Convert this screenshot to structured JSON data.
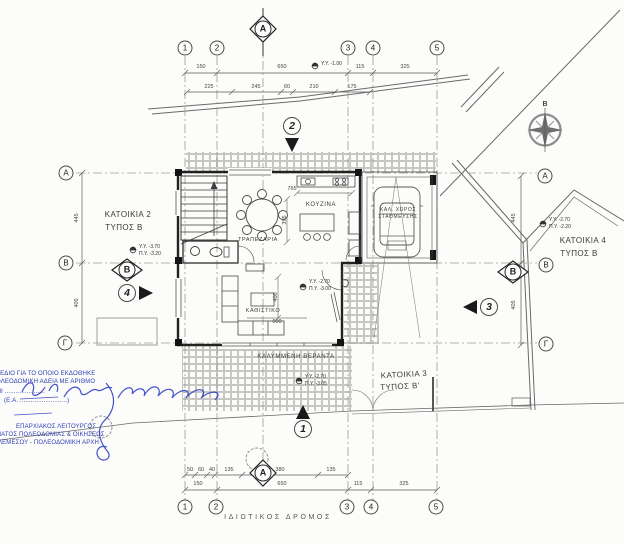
{
  "grid": {
    "cols": [
      "1",
      "2",
      "3",
      "4",
      "5"
    ],
    "rows": [
      "Α",
      "Β",
      "Γ"
    ],
    "section_a": "Α",
    "section_b": "Β"
  },
  "view_markers": {
    "m1": "1",
    "m2": "2",
    "m3": "3",
    "m4": "4"
  },
  "north_label": "Β",
  "houses": {
    "h2_line1": "ΚΑΤΟΙΚΙΑ 2",
    "h2_line2": "ΤΥΠΟΣ Β",
    "h3_line1": "ΚΑΤΟΙΚΙΑ 3",
    "h3_line2": "ΤΥΠΟΣ Β'",
    "h4_line1": "ΚΑΤΟΙΚΙΑ 4",
    "h4_line2": "ΤΥΠΟΣ Β"
  },
  "rooms": {
    "kitchen": "ΚΟΥΖΙΝΑ",
    "dining": "ΤΡΑΠΕΖΑΡΙΑ",
    "living": "ΚΑΘΙΣΤΙΚΟ",
    "veranda": "ΚΑΛΥΜΜΕΝΗ ΒΕΡΑΝΤΑ",
    "parking1": "ΚΑΛ. ΧΩΡΟΣ",
    "parking2": "ΣΤΑΘΜΕΥΣΗΣ"
  },
  "levels": {
    "top": "Υ.Υ. -1.00",
    "house2_yy": "Υ.Υ. -3.70",
    "house2_py": "Π.Υ. -3.20",
    "house4_yy": "Υ.Υ. -2.70",
    "house4_py": "Π.Υ. -2.20",
    "living_yy": "Υ.Υ. -2.70",
    "living_py": "Π.Υ. -3.00",
    "veranda_yy": "Υ.Υ. -2.70",
    "veranda_py": "Π.Υ. -3.05"
  },
  "dims": {
    "top1": [
      "150",
      "650",
      "115",
      "325"
    ],
    "top2": [
      "225",
      "245",
      "60",
      "210",
      "175"
    ],
    "bottom1": [
      "50",
      "60",
      "40",
      "135",
      "380",
      "135"
    ],
    "bottom2": [
      "150",
      "650",
      "115",
      "325"
    ],
    "left": [
      "445",
      "405"
    ],
    "right": [
      "445",
      "405"
    ],
    "interior": {
      "kitchen_w": "765",
      "kitchen_h": "395",
      "living_h": "400",
      "living_w": "600"
    }
  },
  "road_label": "ΙΔΙΩΤΙΚΟΣ ΔΡΟΜΟΣ",
  "stamp": {
    "line1": "ΧΕΔΙΟ ΓΙΑ ΤΟ ΟΠΟΙΟ ΕΚΔΟΘΗΚΕ",
    "line2": "ΟΛΕΟΔΟΜΙΚΗ ΑΔΕΙΑ ΜΕ ΑΡΙΘΜΟ",
    "line3": "ΜΙ ......................",
    "line4": "(Ε.Α. ..........................)",
    "line5": "ΕΠΑΡΧΙΑΚΟΣ ΛΕΙΤΟΥΡΓΟΣ",
    "line6": "ΜΑΤΟΣ ΠΟΛΕΟΔΟΜΙΑΣ & ΟΙΚΗΣΕΩΣ",
    "line7": "ΛΕΜΕΣΟΥ - ΠΟΛΕΟΔΟΜΙΚΗ ΑΡΧΗ"
  }
}
